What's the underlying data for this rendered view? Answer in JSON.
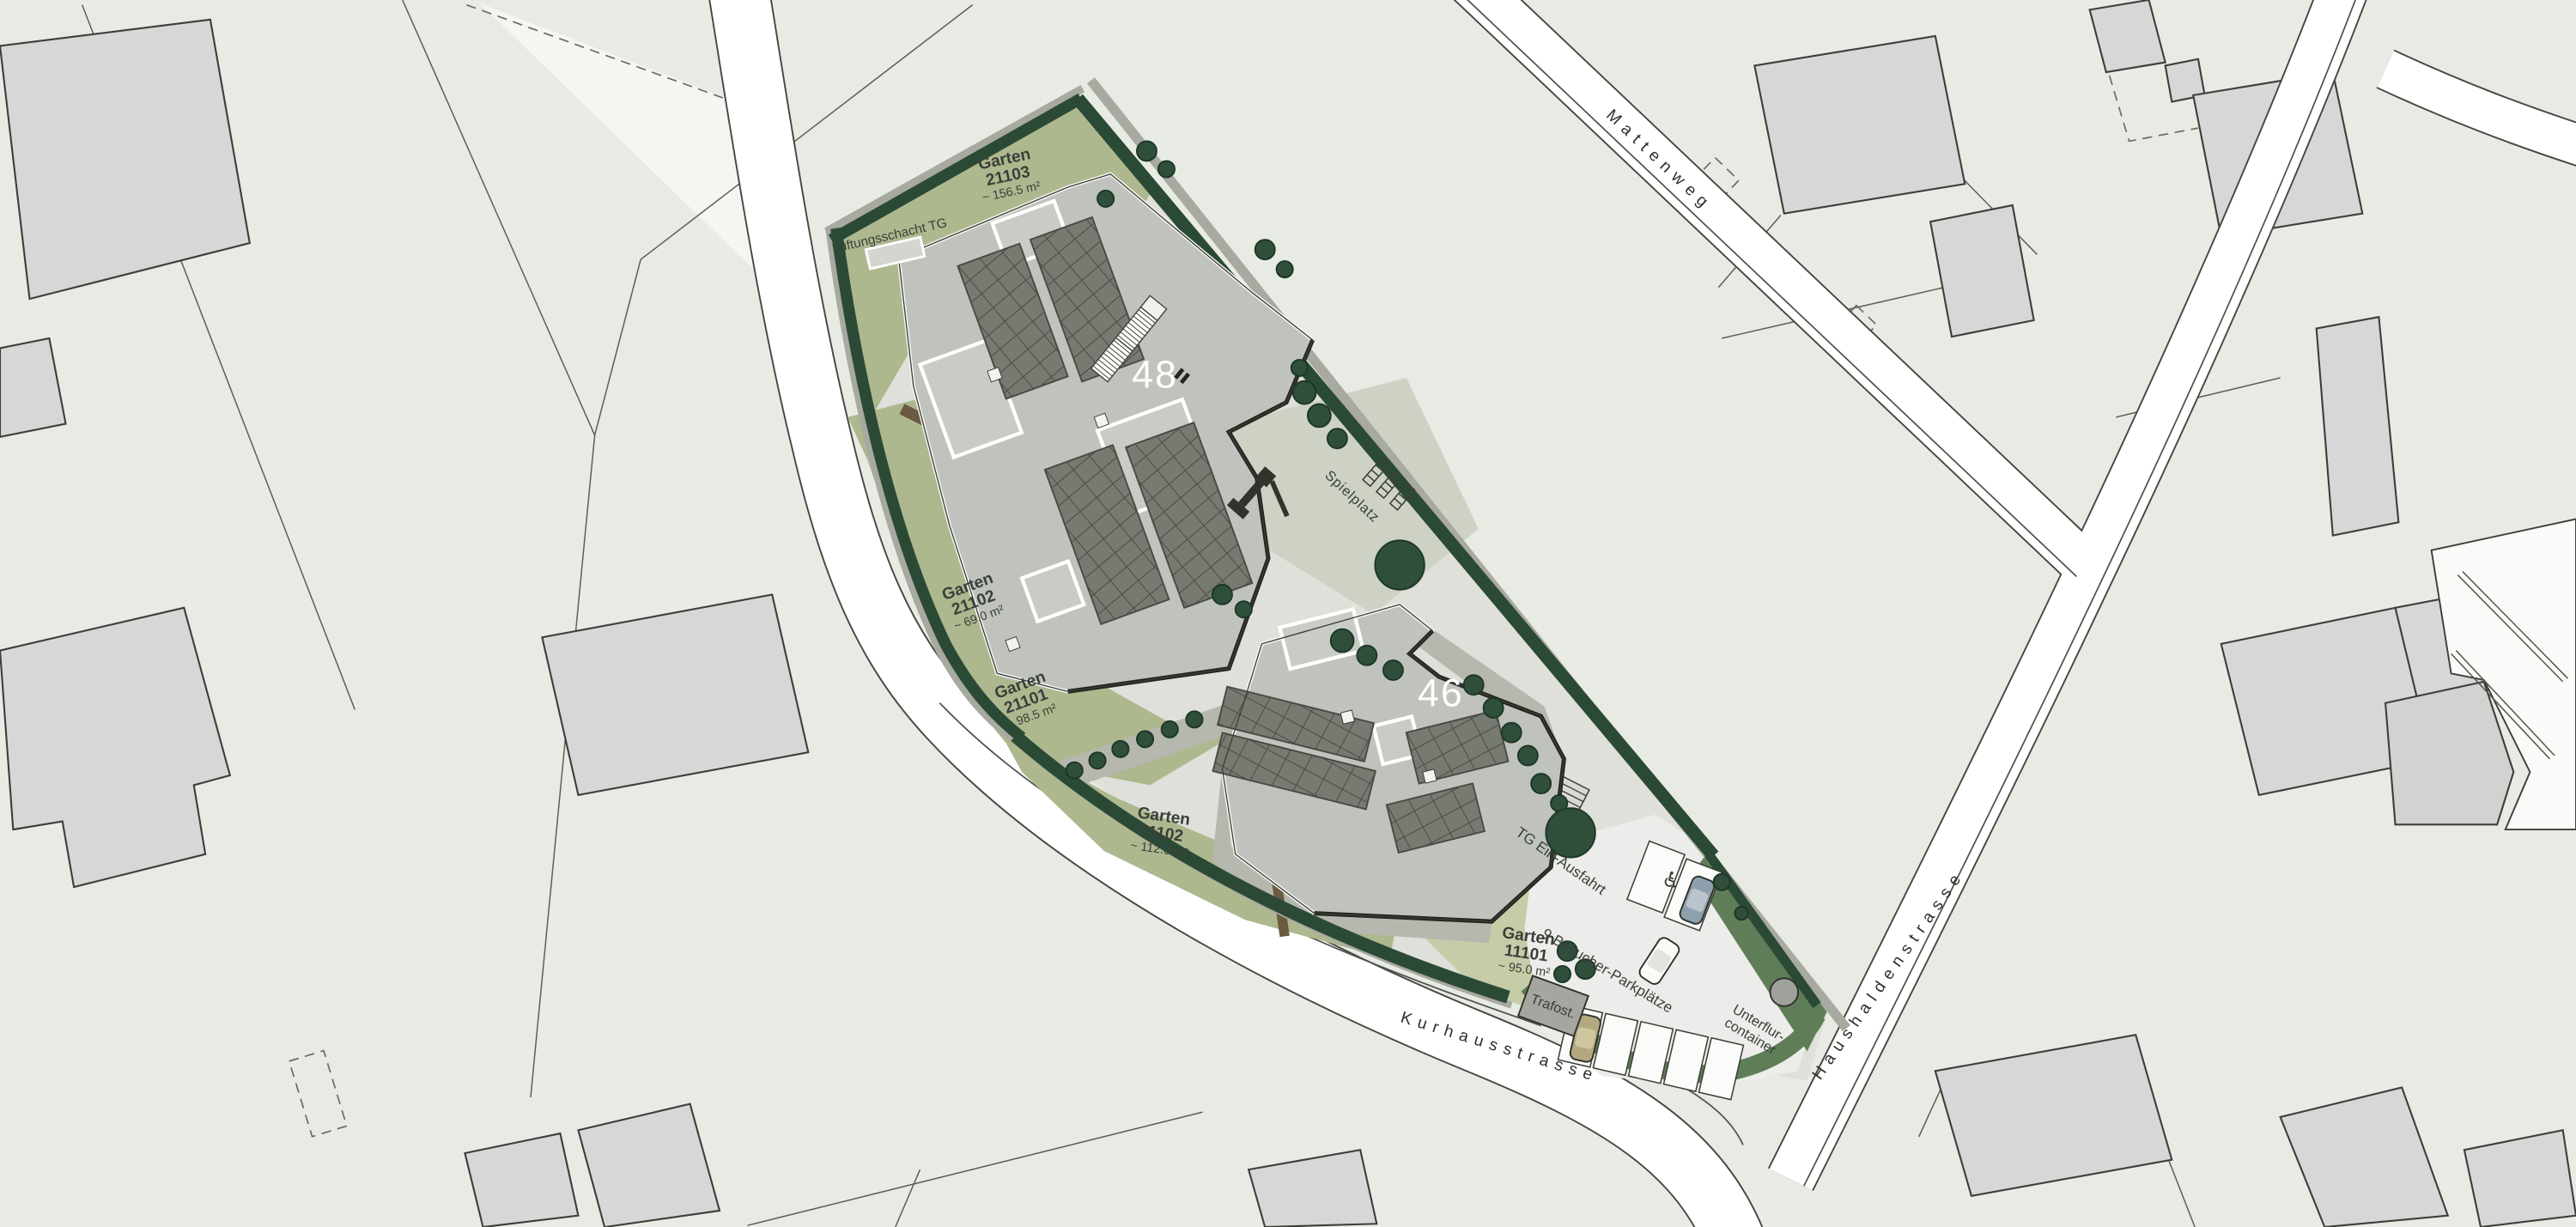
{
  "plan": {
    "building_numbers": {
      "b48": "48",
      "b46": "46"
    },
    "streets": {
      "mattenweg": "Mattenweg",
      "haushaldenstrasse": "Haushaldenstrasse",
      "kurhausstrasse": "Kurhausstrasse"
    },
    "gardens": [
      {
        "name": "Garten",
        "number": "21103",
        "area": "~ 156.5 m²"
      },
      {
        "name": "Garten",
        "number": "21102",
        "area": "~ 69.0 m²"
      },
      {
        "name": "Garten",
        "number": "21101",
        "area": "~ 98.5 m²"
      },
      {
        "name": "Garten",
        "number": "11102",
        "area": "~ 112.0 m²"
      },
      {
        "name": "Garten",
        "number": "11101",
        "area": "~ 95.0 m²"
      }
    ],
    "labels": {
      "lueftungsschacht": "Lüftungsschacht TG",
      "spielplatz": "Spielplatz",
      "tg_ein_ausfahrt": "TG Ein-Ausfahrt",
      "besucher_parkplaetze": "9 Besucher-Parkplätze",
      "unterflur_line1": "Unterflur-",
      "unterflur_line2": "container",
      "trafostation": "Trafost."
    },
    "icons": {
      "wheelchair": "♿"
    },
    "colors": {
      "background": "#e8ebe4",
      "street_white": "#ffffff",
      "garden_green": "#aeb88f",
      "hedge_green": "#2b4a36",
      "verge_green": "#5f7d57",
      "roof_gray": "#c0c3bd",
      "panel_gray": "#767a71",
      "context_building": "#d8d6d7"
    }
  }
}
